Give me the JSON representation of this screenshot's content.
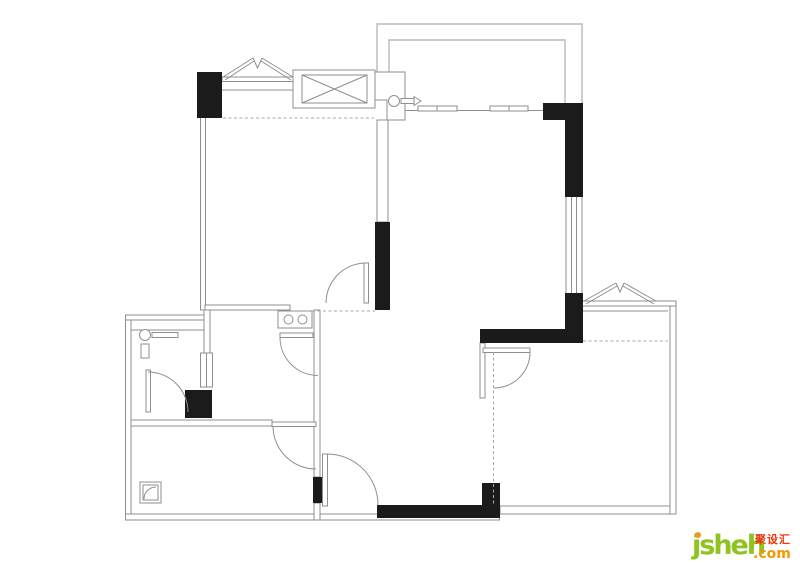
{
  "palette": {
    "wall": "#1b1b1b",
    "line": "#8f8f8f",
    "line_light": "#b9b9b9",
    "dotted": "#a8a8a8"
  },
  "logo": {
    "brand": "jsheh",
    "tld": ".com",
    "cjk": "聚设汇",
    "brand_color": "#8fc31f",
    "tld_color": "#f39800",
    "cjk_color": "#e8380d",
    "dot_color": "#f7941d"
  }
}
